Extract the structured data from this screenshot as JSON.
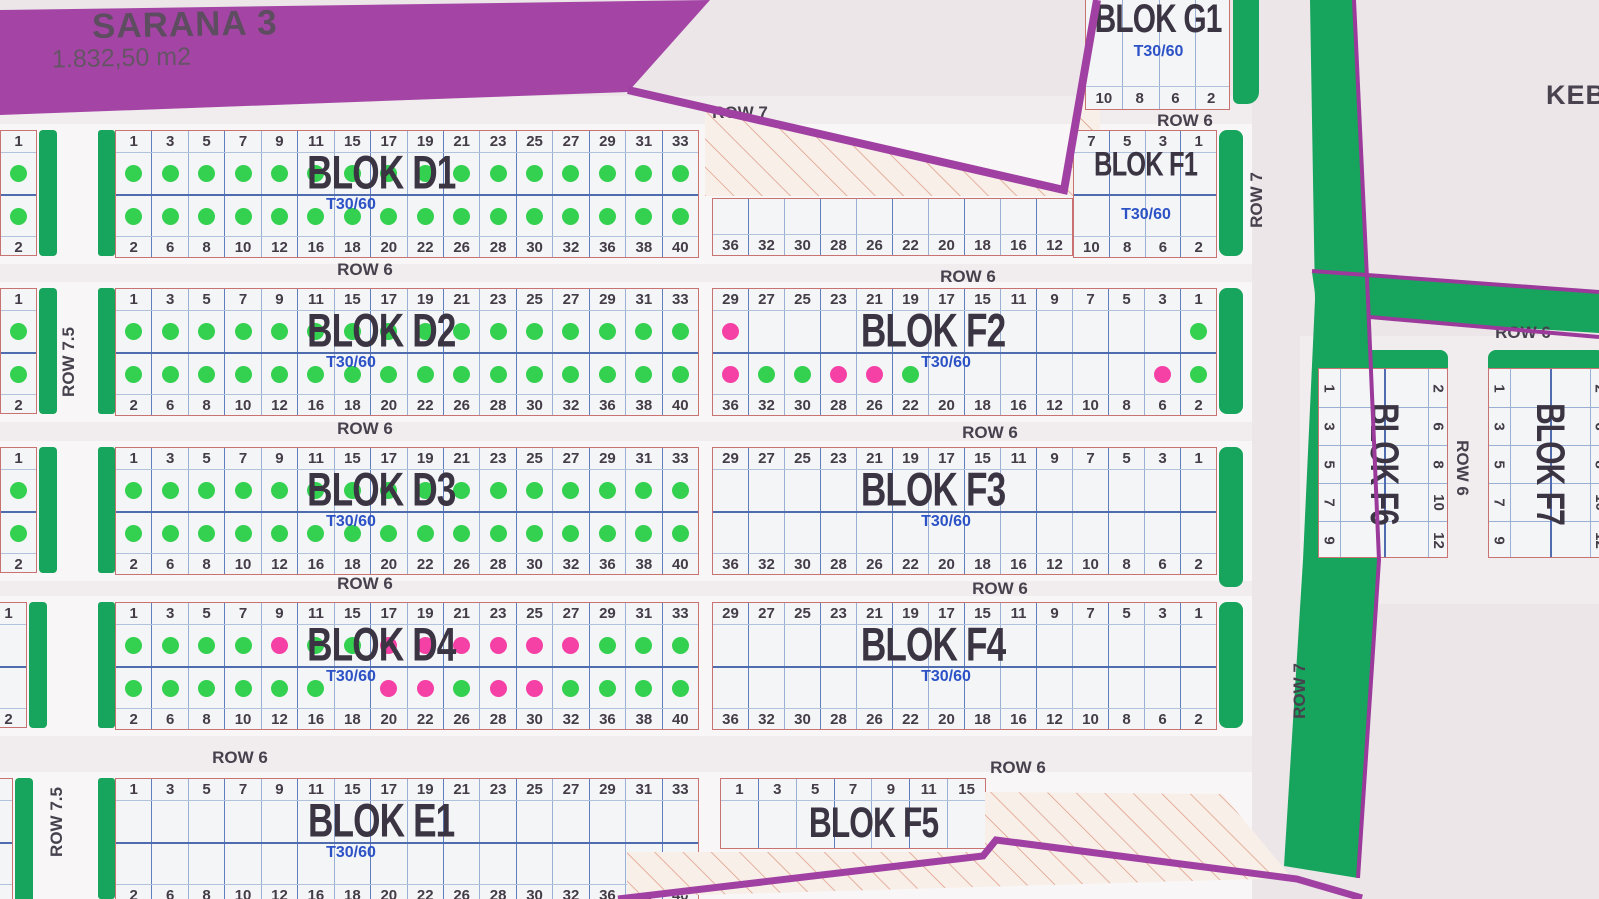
{
  "title": {
    "name": "SARANA 3",
    "area": "1.832,50 m2"
  },
  "corner_text": "KEB",
  "unit_type": "T30/60",
  "road_labels": {
    "row6": "ROW 6",
    "row7": "ROW 7",
    "row75": "ROW 7.5"
  },
  "status_colors": {
    "available_green": "#33d14f",
    "sold_pink": "#f540a5"
  },
  "map_colors": {
    "road_green": "#17a45c",
    "boundary_purple": "#a040a2",
    "block_border_red": "#c87272",
    "grid_blue": "#5e7cbb"
  },
  "blocks": {
    "D1": {
      "label": "BLOK D1",
      "type": "T30/60",
      "top_numbers": [
        "1",
        "3",
        "5",
        "7",
        "9",
        "11",
        "15",
        "17",
        "19",
        "21",
        "23",
        "25",
        "27",
        "29",
        "31",
        "33"
      ],
      "bottom_numbers": [
        "2",
        "6",
        "8",
        "10",
        "12",
        "16",
        "18",
        "20",
        "22",
        "26",
        "28",
        "30",
        "32",
        "36",
        "38",
        "40"
      ],
      "top_dots": [
        "g",
        "g",
        "g",
        "g",
        "g",
        "g",
        "g",
        "g",
        "g",
        "g",
        "g",
        "g",
        "g",
        "g",
        "g",
        "g"
      ],
      "bottom_dots": [
        "g",
        "g",
        "g",
        "g",
        "g",
        "g",
        "g",
        "g",
        "g",
        "g",
        "g",
        "g",
        "g",
        "g",
        "g",
        "g"
      ]
    },
    "D2": {
      "label": "BLOK D2",
      "type": "T30/60",
      "top_numbers": [
        "1",
        "3",
        "5",
        "7",
        "9",
        "11",
        "15",
        "17",
        "19",
        "21",
        "23",
        "25",
        "27",
        "29",
        "31",
        "33"
      ],
      "bottom_numbers": [
        "2",
        "6",
        "8",
        "10",
        "12",
        "16",
        "18",
        "20",
        "22",
        "26",
        "28",
        "30",
        "32",
        "36",
        "38",
        "40"
      ],
      "top_dots": [
        "g",
        "g",
        "g",
        "g",
        "g",
        "g",
        "g",
        "g",
        "g",
        "g",
        "g",
        "g",
        "g",
        "g",
        "g",
        "g"
      ],
      "bottom_dots": [
        "g",
        "g",
        "g",
        "g",
        "g",
        "g",
        "g",
        "g",
        "g",
        "g",
        "g",
        "g",
        "g",
        "g",
        "g",
        "g"
      ]
    },
    "D3": {
      "label": "BLOK D3",
      "type": "T30/60",
      "top_numbers": [
        "1",
        "3",
        "5",
        "7",
        "9",
        "11",
        "15",
        "17",
        "19",
        "21",
        "23",
        "25",
        "27",
        "29",
        "31",
        "33"
      ],
      "bottom_numbers": [
        "2",
        "6",
        "8",
        "10",
        "12",
        "16",
        "18",
        "20",
        "22",
        "26",
        "28",
        "30",
        "32",
        "36",
        "38",
        "40"
      ],
      "top_dots": [
        "g",
        "g",
        "g",
        "g",
        "g",
        "g",
        "g",
        "g",
        "g",
        "g",
        "g",
        "g",
        "g",
        "g",
        "g",
        "g"
      ],
      "bottom_dots": [
        "g",
        "g",
        "g",
        "g",
        "g",
        "g",
        "g",
        "g",
        "g",
        "g",
        "g",
        "g",
        "g",
        "g",
        "g",
        "g"
      ]
    },
    "D4": {
      "label": "BLOK D4",
      "type": "T30/60",
      "top_numbers": [
        "1",
        "3",
        "5",
        "7",
        "9",
        "11",
        "15",
        "17",
        "19",
        "21",
        "23",
        "25",
        "27",
        "29",
        "31",
        "33"
      ],
      "bottom_numbers": [
        "2",
        "6",
        "8",
        "10",
        "12",
        "16",
        "18",
        "20",
        "22",
        "26",
        "28",
        "30",
        "32",
        "36",
        "38",
        "40"
      ],
      "top_dots": [
        "g",
        "g",
        "g",
        "g",
        "p",
        "g",
        "g",
        "p",
        "p",
        "p",
        "p",
        "p",
        "p",
        "g",
        "g",
        "g"
      ],
      "bottom_dots": [
        "g",
        "g",
        "g",
        "g",
        "g",
        "g",
        "",
        "p",
        "p",
        "g",
        "p",
        "p",
        "g",
        "g",
        "g",
        "g"
      ]
    },
    "E1": {
      "label": "BLOK E1",
      "type": "T30/60",
      "top_numbers": [
        "1",
        "3",
        "5",
        "7",
        "9",
        "11",
        "15",
        "17",
        "19",
        "21",
        "23",
        "25",
        "27",
        "29",
        "31",
        "33"
      ],
      "bottom_numbers": [
        "2",
        "6",
        "8",
        "10",
        "12",
        "16",
        "18",
        "20",
        "22",
        "26",
        "28",
        "30",
        "32",
        "36",
        "38",
        "40"
      ]
    },
    "F1_left": {
      "bottom_numbers": [
        "36",
        "32",
        "30",
        "28",
        "26",
        "22",
        "20",
        "18",
        "16",
        "12"
      ]
    },
    "F1": {
      "label": "BLOK F1",
      "type": "T30/60",
      "top_numbers": [
        "7",
        "5",
        "3",
        "1"
      ],
      "bottom_numbers": [
        "10",
        "8",
        "6",
        "2"
      ]
    },
    "G1": {
      "label": "BLOK G1",
      "type": "T30/60",
      "bottom_numbers": [
        "10",
        "8",
        "6",
        "2"
      ]
    },
    "F2": {
      "label": "BLOK F2",
      "type": "T30/60",
      "top_numbers": [
        "29",
        "27",
        "25",
        "23",
        "21",
        "19",
        "17",
        "15",
        "11",
        "9",
        "7",
        "5",
        "3",
        "1"
      ],
      "bottom_numbers": [
        "36",
        "32",
        "30",
        "28",
        "26",
        "22",
        "20",
        "18",
        "16",
        "12",
        "10",
        "8",
        "6",
        "2"
      ],
      "top_dots": [
        "p",
        "",
        "",
        "",
        "",
        "",
        "",
        "",
        "",
        "",
        "",
        "",
        "",
        "g"
      ],
      "bottom_dots": [
        "p",
        "g",
        "g",
        "p",
        "p",
        "g",
        "",
        "",
        "",
        "",
        "",
        "",
        "p",
        "g"
      ]
    },
    "F3": {
      "label": "BLOK F3",
      "type": "T30/60",
      "top_numbers": [
        "29",
        "27",
        "25",
        "23",
        "21",
        "19",
        "17",
        "15",
        "11",
        "9",
        "7",
        "5",
        "3",
        "1"
      ],
      "bottom_numbers": [
        "36",
        "32",
        "30",
        "28",
        "26",
        "22",
        "20",
        "18",
        "16",
        "12",
        "10",
        "8",
        "6",
        "2"
      ]
    },
    "F4": {
      "label": "BLOK F4",
      "type": "T30/60",
      "top_numbers": [
        "29",
        "27",
        "25",
        "23",
        "21",
        "19",
        "17",
        "15",
        "11",
        "9",
        "7",
        "5",
        "3",
        "1"
      ],
      "bottom_numbers": [
        "36",
        "32",
        "30",
        "28",
        "26",
        "22",
        "20",
        "18",
        "16",
        "12",
        "10",
        "8",
        "6",
        "2"
      ]
    },
    "F5": {
      "label": "BLOK F5",
      "top_numbers": [
        "1",
        "3",
        "5",
        "7",
        "9",
        "11",
        "15"
      ]
    },
    "F6": {
      "label": "BLOK F6",
      "left_numbers": [
        "1",
        "3",
        "5",
        "7",
        "9"
      ],
      "right_numbers": [
        "2",
        "6",
        "8",
        "10",
        "12"
      ]
    },
    "F7": {
      "label": "BLOK F7",
      "left_numbers": [
        "1",
        "3",
        "5",
        "7",
        "9"
      ],
      "right_numbers": [
        "2",
        "6",
        "8",
        "10",
        "12"
      ]
    }
  },
  "partial_blocks": [
    {
      "top": "1",
      "bottom": "2",
      "dots": [
        "g",
        "g"
      ]
    },
    {
      "top": "1",
      "bottom": "2",
      "dots": [
        "g",
        "g"
      ]
    },
    {
      "top": "1",
      "bottom": "2",
      "dots": [
        "g",
        "g"
      ]
    },
    {
      "top": "1",
      "bottom": "2",
      "dots": [
        "",
        ""
      ]
    },
    {
      "top": "1",
      "bottom": "2",
      "dots": [
        "",
        ""
      ]
    }
  ]
}
